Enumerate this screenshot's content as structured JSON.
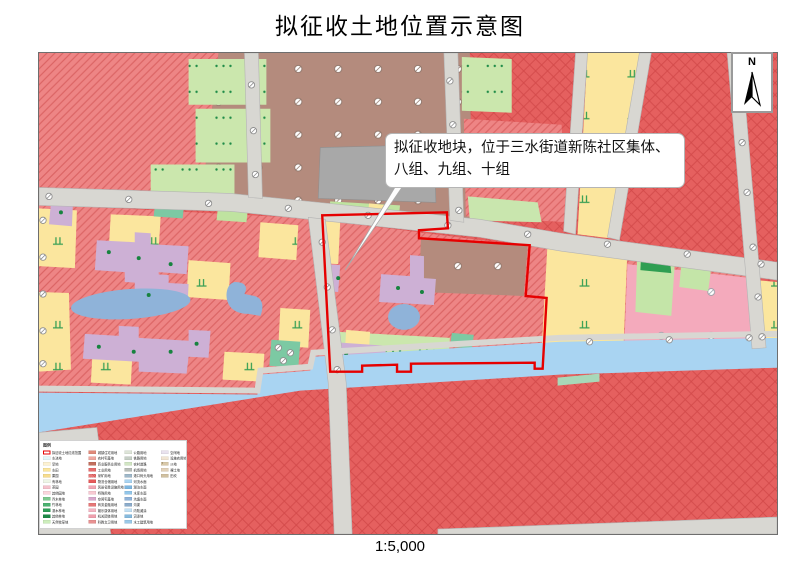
{
  "title": "拟征收土地位置示意图",
  "scale_label": "1:5,000",
  "north": {
    "label": "N"
  },
  "callout": {
    "line1": "拟征收地块，位于三水街道新陈社区集体、",
    "line2": "八组、九组、十组"
  },
  "colors": {
    "boundary_red": "#e60000",
    "hatch_salmon": "#ee8585",
    "hatch_line": "#dc6565",
    "cross_red": "#e5605f",
    "cross_line": "#d34a4a",
    "village_brown": "#b48b7d",
    "farmland_yellow": "#fbe69e",
    "building_purple": "#cdb0d5",
    "pond_blue": "#8fb3d9",
    "river_blue": "#a9d4f2",
    "road_gray": "#d8d7d2",
    "greenery": "#cbe7ad",
    "pink_zone": "#f4aabc",
    "building_gray": "#a8a8a8"
  },
  "legend": {
    "title": "图例",
    "columns": [
      [
        {
          "label": "拟征收土地红线范围",
          "color": "#ffffff",
          "outline": "#e60000"
        },
        {
          "label": "水浇地",
          "color": "#e4f5f8"
        },
        {
          "label": "旱地",
          "color": "#fdf2d2"
        },
        {
          "label": "水田",
          "color": "#fbe69e"
        },
        {
          "label": "果园",
          "color": "#f7dd8e"
        },
        {
          "label": "有林地",
          "color": "#eef6e6"
        },
        {
          "label": "茶园",
          "color": "#f5c2cc"
        },
        {
          "label": "其他园地",
          "color": "#fad6dc"
        },
        {
          "label": "乔木林地",
          "color": "#7ec98f"
        },
        {
          "label": "竹林地",
          "color": "#4cb271"
        },
        {
          "label": "灌木林地",
          "color": "#2e9e57"
        },
        {
          "label": "其他林地",
          "color": "#1d8a47"
        },
        {
          "label": "天然牧草地",
          "color": "#cdeebc"
        }
      ],
      [
        {
          "label": "城镇住宅用地",
          "color": "#e08a7a"
        },
        {
          "label": "农村宅基地",
          "color": "#efa8a0"
        },
        {
          "label": "商业服务业用地",
          "color": "#c2705f"
        },
        {
          "label": "工业用地",
          "color": "#e66d6d"
        },
        {
          "label": "采矿用地",
          "color": "#ef8585",
          "style": "hatch"
        },
        {
          "label": "物流仓储用地",
          "color": "#e65a5a"
        },
        {
          "label": "风景名胜设施用地",
          "color": "#f2a6b4"
        },
        {
          "label": "特殊用地",
          "color": "#f8c9d2"
        },
        {
          "label": "空闲宅基地",
          "color": "#d8a8cc"
        },
        {
          "label": "商务金融用地",
          "color": "#e67878"
        },
        {
          "label": "娱乐康体用地",
          "color": "#f4b4c2"
        },
        {
          "label": "机关团体用地",
          "color": "#efa0ae"
        },
        {
          "label": "科教文卫用地",
          "color": "#e89292"
        }
      ],
      [
        {
          "label": "公路用地",
          "color": "#dde4d8"
        },
        {
          "label": "铁路用地",
          "color": "#c6cfc6"
        },
        {
          "label": "农村道路",
          "color": "#d2e6c4"
        },
        {
          "label": "机场用地",
          "color": "#b8bdb8"
        },
        {
          "label": "港口码头用地",
          "color": "#9fb8ca"
        },
        {
          "label": "河流水面",
          "color": "#a9d4f2"
        },
        {
          "label": "湖泊水面",
          "color": "#7db6e0"
        },
        {
          "label": "水库水面",
          "color": "#92c6ea"
        },
        {
          "label": "坑塘水面",
          "color": "#8fb3d9"
        },
        {
          "label": "沟渠",
          "color": "#8caccb"
        },
        {
          "label": "内陆滩涂",
          "color": "#c2e0f4"
        },
        {
          "label": "沼泽地",
          "color": "#86bade"
        },
        {
          "label": "水工建筑用地",
          "color": "#9ac9e8"
        }
      ],
      [
        {
          "label": "空闲地",
          "color": "#e9e2ee"
        },
        {
          "label": "设施农用地",
          "color": "#f1e5d3"
        },
        {
          "label": "沙地",
          "color": "#d9c9a9",
          "style": "dots"
        },
        {
          "label": "裸土地",
          "color": "#e2d2ba"
        },
        {
          "label": "田坎",
          "color": "#d1c1a1"
        }
      ]
    ]
  }
}
